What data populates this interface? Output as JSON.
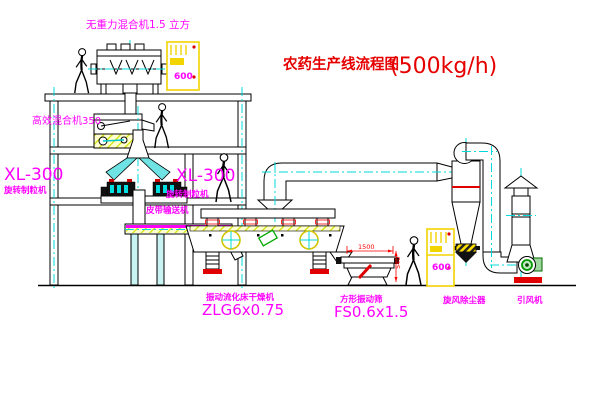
{
  "header": {
    "title_zh": "农药生产线流程图",
    "capacity": "(500kg/h)"
  },
  "equipment": {
    "gravity_mixer": {
      "label": "无重力混合机1.5 立方"
    },
    "high_efficiency_mixer": {
      "label": "高效混合机350"
    },
    "granulator_left": {
      "model": "XL-300",
      "name": "旋转制粒机"
    },
    "granulator_right": {
      "model": "XL-300",
      "name": "旋转制粒机"
    },
    "belt_conveyor": {
      "name": "皮带输送机"
    },
    "fluid_bed_dryer": {
      "name": "振动流化床干燥机",
      "model": "ZLG6x0.75"
    },
    "vibrating_screen": {
      "name": "方形振动筛",
      "model": "FS0.6x1.5",
      "dim_width": "1500",
      "dim_height": "540"
    },
    "cyclone": {
      "name": "旋风除尘器"
    },
    "induced_draft_fan": {
      "name": "引风机"
    },
    "control_cabinet_top": {
      "text": "600"
    },
    "control_cabinet_right": {
      "text": "600"
    }
  },
  "colors": {
    "label_magenta": "#ff00ff",
    "title_red": "#e60000",
    "centerline_cyan": "#00d9d9",
    "cabinet_yellow": "#f2d400",
    "dimension_red": "#ff0000"
  }
}
